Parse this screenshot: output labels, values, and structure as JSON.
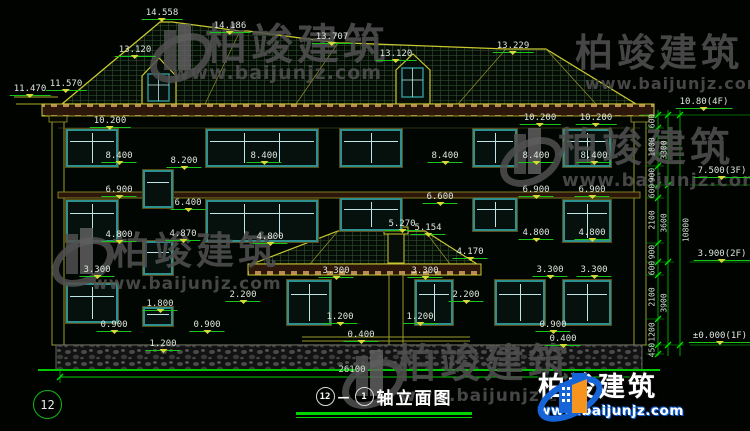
{
  "drawing": {
    "title_axis_start": "12",
    "title_axis_end": "1",
    "title_text": "轴立面图",
    "left_axis_bubble": "12"
  },
  "watermark": {
    "brand": "柏竣建筑",
    "url": "www.baijunjz.com"
  },
  "annotations": [
    {
      "t": "14.558",
      "x": 162,
      "y": 8,
      "k": "level"
    },
    {
      "t": "14.186",
      "x": 230,
      "y": 21,
      "k": "level"
    },
    {
      "t": "13.120",
      "x": 135,
      "y": 45,
      "k": "level"
    },
    {
      "t": "13.707",
      "x": 332,
      "y": 32,
      "k": "level"
    },
    {
      "t": "13.120",
      "x": 396,
      "y": 49,
      "k": "level"
    },
    {
      "t": "13.229",
      "x": 513,
      "y": 41,
      "k": "level"
    },
    {
      "t": "11.470",
      "x": 30,
      "y": 84,
      "k": "level"
    },
    {
      "t": "11.570",
      "x": 66,
      "y": 79,
      "k": "level"
    },
    {
      "t": "10.80(4F)",
      "x": 704,
      "y": 97,
      "k": "level"
    },
    {
      "t": "7.500(3F)",
      "x": 722,
      "y": 166,
      "k": "level"
    },
    {
      "t": "3.900(2F)",
      "x": 722,
      "y": 249,
      "k": "level"
    },
    {
      "t": "±0.000(1F)",
      "x": 720,
      "y": 331,
      "k": "level"
    },
    {
      "t": "10.200",
      "x": 110,
      "y": 116,
      "k": "level"
    },
    {
      "t": "10.200",
      "x": 540,
      "y": 113,
      "k": "level"
    },
    {
      "t": "10.200",
      "x": 596,
      "y": 113,
      "k": "level"
    },
    {
      "t": "8.400",
      "x": 119,
      "y": 151,
      "k": "level"
    },
    {
      "t": "8.200",
      "x": 184,
      "y": 156,
      "k": "level"
    },
    {
      "t": "8.400",
      "x": 264,
      "y": 151,
      "k": "level"
    },
    {
      "t": "8.400",
      "x": 445,
      "y": 151,
      "k": "level"
    },
    {
      "t": "8.400",
      "x": 536,
      "y": 151,
      "k": "level"
    },
    {
      "t": "8.400",
      "x": 594,
      "y": 151,
      "k": "level"
    },
    {
      "t": "6.900",
      "x": 119,
      "y": 185,
      "k": "level"
    },
    {
      "t": "6.900",
      "x": 536,
      "y": 185,
      "k": "level"
    },
    {
      "t": "6.900",
      "x": 592,
      "y": 185,
      "k": "level"
    },
    {
      "t": "6.600",
      "x": 440,
      "y": 192,
      "k": "level"
    },
    {
      "t": "6.400",
      "x": 188,
      "y": 198,
      "k": "level"
    },
    {
      "t": "5.270",
      "x": 402,
      "y": 219,
      "k": "level"
    },
    {
      "t": "5.154",
      "x": 428,
      "y": 223,
      "k": "level"
    },
    {
      "t": "4.870",
      "x": 183,
      "y": 229,
      "k": "level"
    },
    {
      "t": "4.800",
      "x": 119,
      "y": 230,
      "k": "level"
    },
    {
      "t": "4.800",
      "x": 270,
      "y": 232,
      "k": "level"
    },
    {
      "t": "4.800",
      "x": 536,
      "y": 228,
      "k": "level"
    },
    {
      "t": "4.800",
      "x": 592,
      "y": 228,
      "k": "level"
    },
    {
      "t": "4.170",
      "x": 470,
      "y": 247,
      "k": "level"
    },
    {
      "t": "3.300",
      "x": 97,
      "y": 265,
      "k": "level"
    },
    {
      "t": "3.300",
      "x": 336,
      "y": 266,
      "k": "level"
    },
    {
      "t": "3.300",
      "x": 425,
      "y": 266,
      "k": "level"
    },
    {
      "t": "3.300",
      "x": 550,
      "y": 265,
      "k": "level"
    },
    {
      "t": "3.300",
      "x": 594,
      "y": 265,
      "k": "level"
    },
    {
      "t": "2.200",
      "x": 243,
      "y": 290,
      "k": "level"
    },
    {
      "t": "2.200",
      "x": 466,
      "y": 290,
      "k": "level"
    },
    {
      "t": "1.800",
      "x": 160,
      "y": 299,
      "k": "level"
    },
    {
      "t": "1.200",
      "x": 340,
      "y": 312,
      "k": "level"
    },
    {
      "t": "1.200",
      "x": 420,
      "y": 312,
      "k": "level"
    },
    {
      "t": "1.200",
      "x": 163,
      "y": 339,
      "k": "level"
    },
    {
      "t": "0.900",
      "x": 114,
      "y": 320,
      "k": "level"
    },
    {
      "t": "0.900",
      "x": 207,
      "y": 320,
      "k": "level"
    },
    {
      "t": "0.900",
      "x": 553,
      "y": 320,
      "k": "level"
    },
    {
      "t": "0.400",
      "x": 361,
      "y": 330,
      "k": "level"
    },
    {
      "t": "0.400",
      "x": 563,
      "y": 334,
      "k": "level"
    },
    {
      "t": "26100",
      "x": 352,
      "y": 365,
      "k": "dim"
    },
    {
      "t": "600",
      "x": 652,
      "y": 121,
      "k": "rot"
    },
    {
      "t": "1800",
      "x": 652,
      "y": 147,
      "k": "rot"
    },
    {
      "t": "900",
      "x": 652,
      "y": 175,
      "k": "rot"
    },
    {
      "t": "600",
      "x": 652,
      "y": 191,
      "k": "rot"
    },
    {
      "t": "2100",
      "x": 652,
      "y": 220,
      "k": "rot"
    },
    {
      "t": "900",
      "x": 652,
      "y": 252,
      "k": "rot"
    },
    {
      "t": "600",
      "x": 652,
      "y": 268,
      "k": "rot"
    },
    {
      "t": "2100",
      "x": 652,
      "y": 297,
      "k": "rot"
    },
    {
      "t": "1200",
      "x": 652,
      "y": 332,
      "k": "rot"
    },
    {
      "t": "450",
      "x": 652,
      "y": 350,
      "k": "rot"
    },
    {
      "t": "3300",
      "x": 664,
      "y": 150,
      "k": "rot"
    },
    {
      "t": "3600",
      "x": 664,
      "y": 223,
      "k": "rot"
    },
    {
      "t": "3900",
      "x": 664,
      "y": 303,
      "k": "rot"
    },
    {
      "t": "10800",
      "x": 686,
      "y": 230,
      "k": "rot"
    }
  ]
}
